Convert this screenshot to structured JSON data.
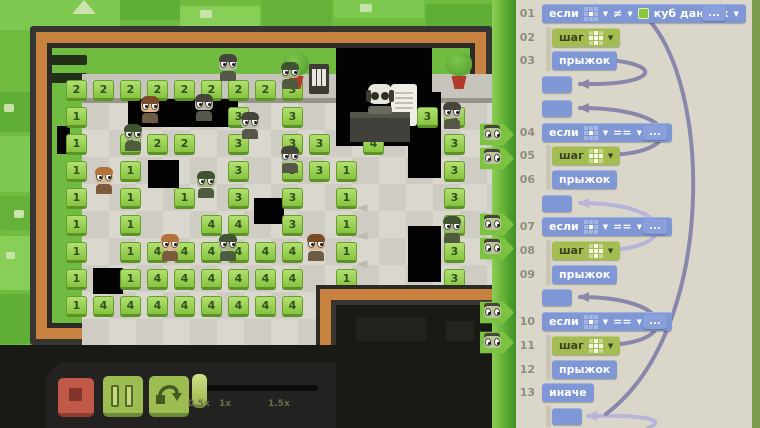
{
  "ui": {
    "caret": "▼",
    "grid_if_lit": [
      4
    ],
    "grid_step_lit": [
      1,
      3,
      4,
      5,
      7
    ]
  },
  "menu": {
    "icon": "hamburger-menu"
  },
  "program": {
    "rows": [
      {
        "num": "01",
        "type": "if",
        "keyword": "если",
        "op": "≠",
        "value": "куб данных",
        "cube": true,
        "dots": "..."
      },
      {
        "num": "02",
        "type": "step",
        "keyword": "шаг"
      },
      {
        "num": "03",
        "type": "jump",
        "keyword": "прыжок"
      },
      {
        "type": "label"
      },
      {
        "type": "label"
      },
      {
        "num": "04",
        "type": "if",
        "keyword": "если",
        "op": "==",
        "value": "1",
        "cube": false,
        "dots": "..."
      },
      {
        "num": "05",
        "type": "step",
        "keyword": "шаг"
      },
      {
        "num": "06",
        "type": "jump",
        "keyword": "прыжок"
      },
      {
        "type": "label"
      },
      {
        "num": "07",
        "type": "if",
        "keyword": "если",
        "op": "==",
        "value": "2",
        "cube": false,
        "dots": "..."
      },
      {
        "num": "08",
        "type": "step",
        "keyword": "шаг"
      },
      {
        "num": "09",
        "type": "jump",
        "keyword": "прыжок"
      },
      {
        "type": "label"
      },
      {
        "num": "10",
        "type": "if",
        "keyword": "если",
        "op": "==",
        "value": "3",
        "cube": false,
        "dots": "..."
      },
      {
        "num": "11",
        "type": "step",
        "keyword": "шаг"
      },
      {
        "num": "12",
        "type": "jump",
        "keyword": "прыжок"
      },
      {
        "num": "13",
        "type": "else",
        "keyword": "иначе"
      },
      {
        "type": "label",
        "indent": 1
      }
    ],
    "guides": [
      [
        1,
        2
      ],
      [
        6,
        7
      ],
      [
        10,
        11
      ],
      [
        14,
        15
      ],
      [
        17,
        17
      ]
    ],
    "arcs": [
      {
        "tone": "dark",
        "path": "M610,60 C668,66 652,86 580,84",
        "tip": [
          578,
          84
        ]
      },
      {
        "tone": "dark",
        "path": "M610,155 C688,152 680,108 580,108",
        "tip": [
          578,
          108
        ]
      },
      {
        "tone": "light",
        "path": "M610,250 C682,246 672,203 580,203",
        "tip": [
          578,
          203
        ]
      },
      {
        "tone": "dark",
        "path": "M610,345 C682,341 672,297 580,297",
        "tip": [
          578,
          297
        ]
      },
      {
        "tone": "light",
        "path": "M648,428 C672,418 632,415 588,416",
        "tip": [
          586,
          416
        ]
      },
      {
        "tone": "dark",
        "path": "M645,16 C712,80 718,330 606,414",
        "tip": null
      }
    ]
  },
  "board": {
    "tiles": [
      [
        0,
        0,
        2
      ],
      [
        1,
        0,
        2
      ],
      [
        2,
        0,
        2
      ],
      [
        3,
        0,
        2
      ],
      [
        4,
        0,
        2
      ],
      [
        5,
        0,
        2
      ],
      [
        6,
        0,
        2
      ],
      [
        7,
        0,
        2
      ],
      [
        8,
        0,
        3
      ],
      [
        0,
        1,
        1
      ],
      [
        6,
        1,
        3
      ],
      [
        8,
        1,
        3
      ],
      [
        13,
        1,
        3
      ],
      [
        14,
        1,
        3
      ],
      [
        0,
        2,
        1
      ],
      [
        2,
        2,
        2
      ],
      [
        3,
        2,
        2
      ],
      [
        4,
        2,
        2
      ],
      [
        6,
        2,
        3
      ],
      [
        8,
        2,
        3
      ],
      [
        9,
        2,
        3
      ],
      [
        11,
        2,
        4
      ],
      [
        14,
        2,
        3
      ],
      [
        0,
        3,
        1
      ],
      [
        2,
        3,
        1
      ],
      [
        6,
        3,
        3
      ],
      [
        8,
        3,
        3
      ],
      [
        9,
        3,
        3
      ],
      [
        10,
        3,
        1
      ],
      [
        14,
        3,
        3
      ],
      [
        0,
        4,
        1
      ],
      [
        2,
        4,
        1
      ],
      [
        4,
        4,
        1
      ],
      [
        6,
        4,
        3
      ],
      [
        8,
        4,
        3
      ],
      [
        10,
        4,
        1
      ],
      [
        14,
        4,
        3
      ],
      [
        0,
        5,
        1
      ],
      [
        2,
        5,
        1
      ],
      [
        5,
        5,
        4
      ],
      [
        6,
        5,
        4
      ],
      [
        8,
        5,
        3
      ],
      [
        10,
        5,
        1
      ],
      [
        14,
        5,
        3
      ],
      [
        0,
        6,
        1
      ],
      [
        2,
        6,
        1
      ],
      [
        3,
        6,
        4
      ],
      [
        4,
        6,
        4
      ],
      [
        5,
        6,
        4
      ],
      [
        6,
        6,
        4
      ],
      [
        7,
        6,
        4
      ],
      [
        8,
        6,
        4
      ],
      [
        10,
        6,
        1
      ],
      [
        14,
        6,
        3
      ],
      [
        0,
        7,
        1
      ],
      [
        2,
        7,
        1
      ],
      [
        3,
        7,
        4
      ],
      [
        4,
        7,
        4
      ],
      [
        5,
        7,
        4
      ],
      [
        6,
        7,
        4
      ],
      [
        7,
        7,
        4
      ],
      [
        8,
        7,
        4
      ],
      [
        10,
        7,
        1
      ],
      [
        14,
        7,
        3
      ],
      [
        0,
        8,
        1
      ],
      [
        1,
        8,
        4
      ],
      [
        2,
        8,
        4
      ],
      [
        3,
        8,
        4
      ],
      [
        4,
        8,
        4
      ],
      [
        5,
        8,
        4
      ],
      [
        6,
        8,
        4
      ],
      [
        7,
        8,
        4
      ],
      [
        8,
        8,
        4
      ]
    ],
    "voids": [
      [
        128,
        99,
        110,
        28
      ],
      [
        336,
        48,
        96,
        98
      ],
      [
        408,
        92,
        33,
        86
      ],
      [
        148,
        160,
        31,
        28
      ],
      [
        254,
        198,
        30,
        26
      ],
      [
        93,
        268,
        30,
        26
      ],
      [
        408,
        226,
        33,
        56
      ],
      [
        57,
        126,
        13,
        28
      ]
    ],
    "chars": [
      [
        150,
        112,
        "h1"
      ],
      [
        204,
        110,
        "z1"
      ],
      [
        228,
        70,
        "z1"
      ],
      [
        290,
        78,
        "z2"
      ],
      [
        133,
        140,
        "z2"
      ],
      [
        104,
        183,
        "h2"
      ],
      [
        250,
        128,
        "z1"
      ],
      [
        206,
        187,
        "z2"
      ],
      [
        290,
        162,
        "z1"
      ],
      [
        170,
        250,
        "h2"
      ],
      [
        316,
        250,
        "h1"
      ],
      [
        228,
        250,
        "z2"
      ],
      [
        452,
        118,
        "z1"
      ],
      [
        452,
        232,
        "z2"
      ]
    ],
    "palette": {
      "z1": {
        "skin": "#b9b9a6",
        "hair": "#45453c",
        "body": "#57564a"
      },
      "z2": {
        "skin": "#a4b483",
        "hair": "#3f5531",
        "body": "#4d5c3b"
      },
      "h1": {
        "skin": "#dcb88c",
        "hair": "#7b4b28",
        "body": "#6e5b46"
      },
      "h2": {
        "skin": "#dcb88c",
        "hair": "#b5713a",
        "body": "#7c5a3e"
      }
    },
    "room_arrows": [
      [
        356,
        198
      ],
      [
        356,
        226
      ],
      [
        356,
        254
      ]
    ],
    "room_arrow_glyph": "◄",
    "pointer_tags": [
      134,
      158,
      224,
      248,
      312,
      342
    ]
  },
  "controls": {
    "stop": "stop",
    "pause": "pause",
    "step": "step-over",
    "speed_labels": [
      "0.5x",
      "1x",
      "1.5x"
    ]
  },
  "colors": {
    "bg_green": "#6fbc41",
    "frame_orange": "#c8823f",
    "tile_green": "#86c340",
    "block_blue": "#7f97d4",
    "block_green": "#a3bd52",
    "panel_bg": "#dad7ca",
    "arrow_dark": "#8987ab",
    "arrow_light": "#b6b4d8",
    "strip_green": "#55a52f",
    "stop_red": "#c05948",
    "button_green": "#9dbd52"
  }
}
